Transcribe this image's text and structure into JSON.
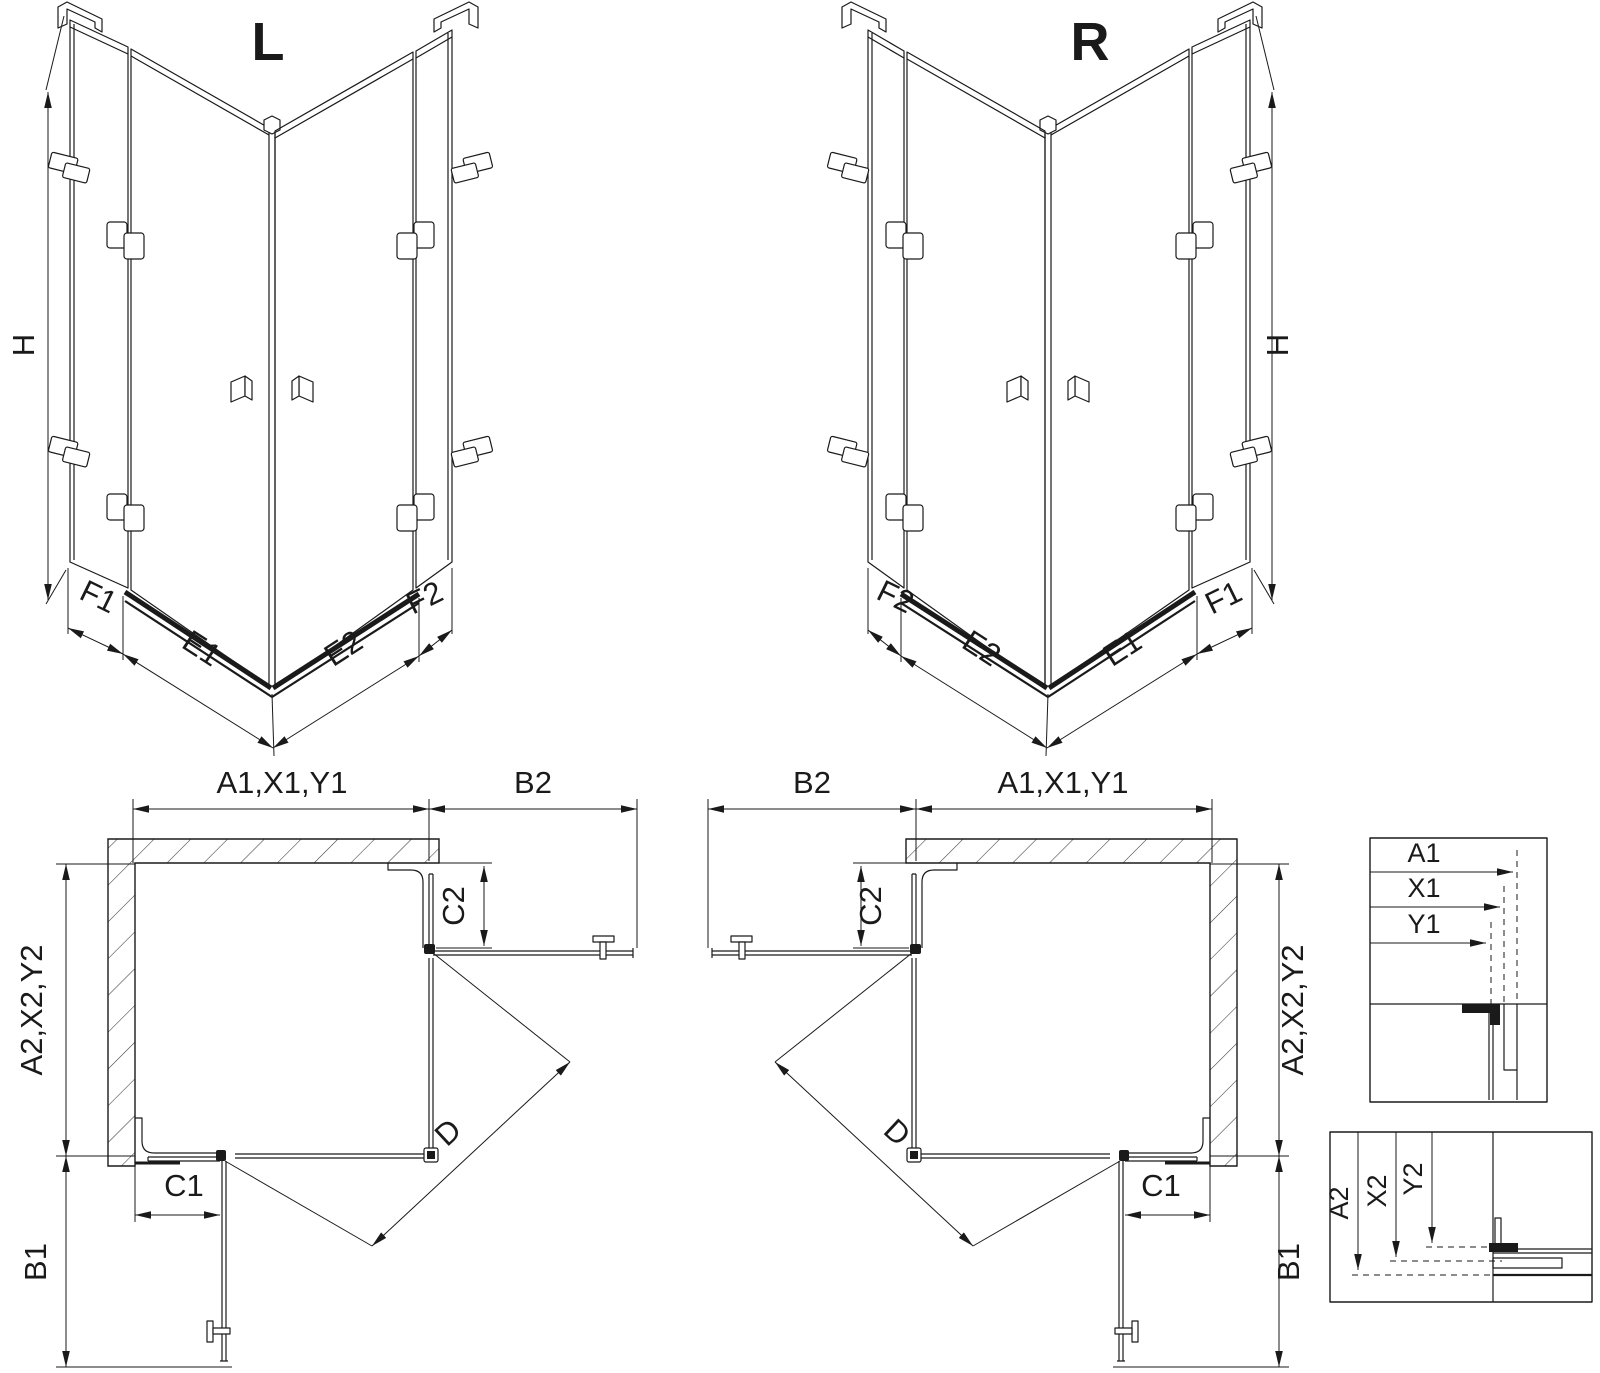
{
  "titles": {
    "left": "L",
    "right": "R"
  },
  "iso": {
    "height": "H",
    "fixed1": "F1",
    "door1": "E1",
    "door2": "E2",
    "fixed2": "F2"
  },
  "plan": {
    "width_top": "A1,X1,Y1",
    "width_side": "B2",
    "fixed_depth_side": "C2",
    "depth_side": "A2,X2,Y2",
    "fixed_width_bottom": "C1",
    "depth_bottom": "B1",
    "diagonal": "D"
  },
  "detail_top": {
    "a1": "A1",
    "x1": "X1",
    "y1": "Y1"
  },
  "detail_bottom": {
    "a2": "A2",
    "x2": "X2",
    "y2": "Y2"
  },
  "colors": {
    "line": "#1a1a1a",
    "background": "#ffffff"
  }
}
